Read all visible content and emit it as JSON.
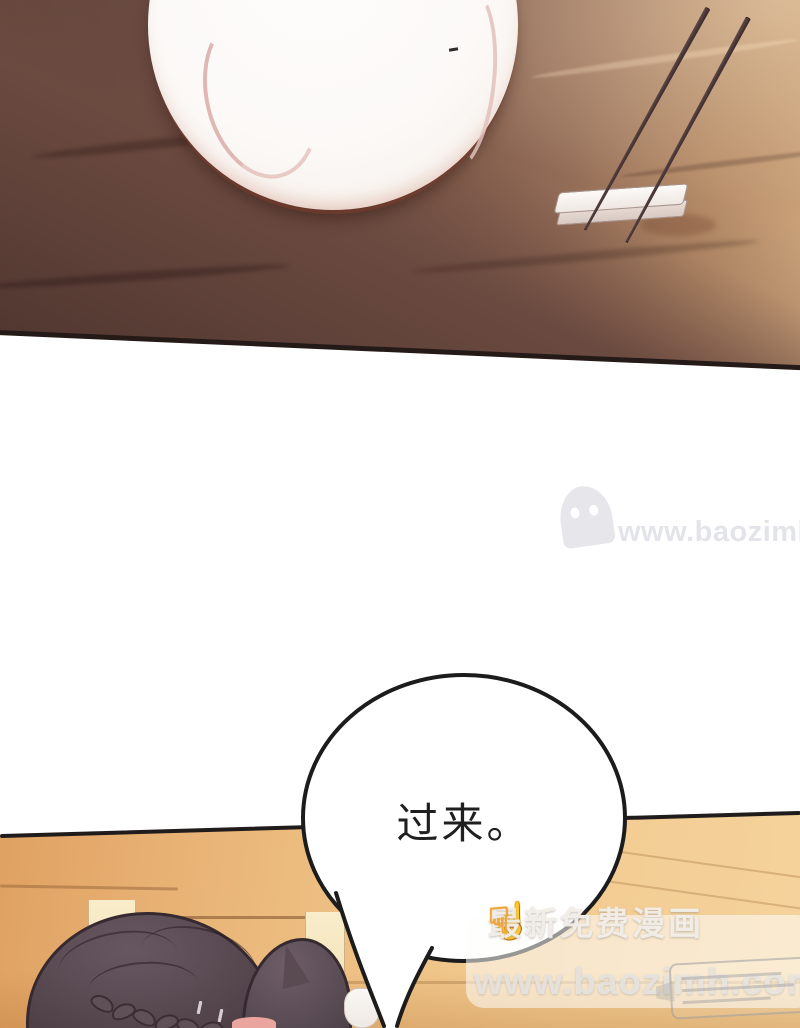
{
  "page": {
    "kind": "manhua comic page",
    "background": "#ffffff"
  },
  "scene": {
    "top_panel_objects": [
      "wooden-table",
      "empty-plate",
      "chopsticks",
      "chopstick-rest"
    ],
    "bottom_panel_objects": [
      "tan-wood-wall",
      "bowing-character-dark-braided-hair",
      "white-cup",
      "speech-bubble"
    ]
  },
  "speech_bubble": {
    "text": "过来。"
  },
  "watermarks": {
    "middle": {
      "icon": "ghost-logo",
      "text": "www.baozimh.com"
    },
    "bottom": {
      "left_icon": "finger-up",
      "right_icon": "finger-down",
      "line1": "最新免费漫画",
      "line2": "www.baozimh.com"
    }
  },
  "colors": {
    "table_wood_dark": "#4c342d",
    "table_wood_light": "#d0a87e",
    "table_edge_line": "#241a18",
    "plate_white": "#fcf9f7",
    "plate_rim_shadow": "#803e2f",
    "plate_arc_pink": "#deb5b0",
    "chopstick_dark": "#342527",
    "chopstick_light": "#6a5450",
    "rest_white": "#fcfaf8",
    "wall_tan_left": "#dfa161",
    "wall_tan_right": "#f5d39c",
    "wall_outline": "#201c1b",
    "hair_base": "#5c4d55",
    "hair_outline": "#362a30",
    "skin_blush": "#eaa69e",
    "bubble_fill": "#ffffff",
    "bubble_stroke": "#1c1c1c",
    "bubble_text": "#1f1f1f",
    "watermark_mid_gray": "#b0b2c2",
    "watermark_text_light": "#efeae4",
    "finger_yellow": "#f1a63c"
  }
}
